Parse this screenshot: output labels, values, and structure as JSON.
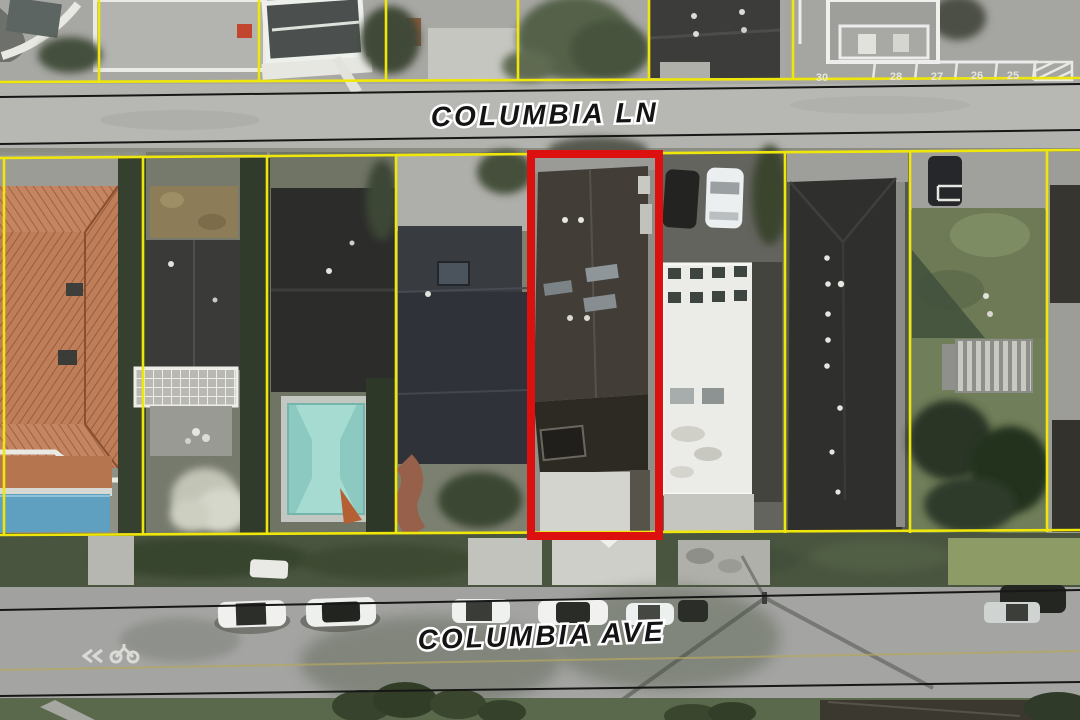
{
  "map": {
    "streets": {
      "top_label": "COLUMBIA LN",
      "bottom_label": "COLUMBIA AVE"
    },
    "parking_stalls": [
      "30",
      "28",
      "27",
      "26",
      "25"
    ],
    "colors": {
      "parcel_boundary_yellow": "#f0e70a",
      "subject_highlight_red": "#dd1010",
      "road_edge_black": "#171717",
      "pool_water_teal": "#8cc9c0",
      "tile_roof_terracotta": "#bd7e59",
      "pavement_gray": "#a2a2a0"
    }
  }
}
